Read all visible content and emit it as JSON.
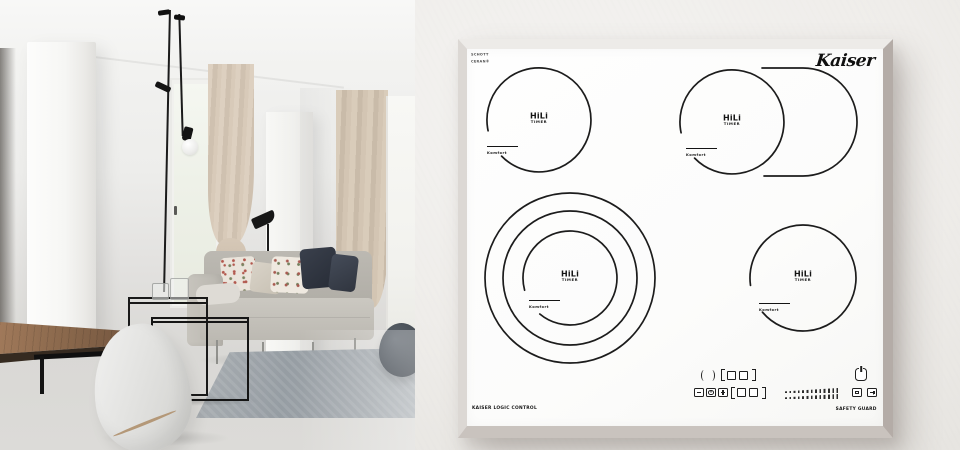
{
  "brand": "Kaiser",
  "glass_brand": {
    "line1": "SCHOTT",
    "line2": "CERAN®"
  },
  "hob": {
    "labels": {
      "logic_control": "KAISER LOGIC CONTROL",
      "safety_guard": "SAFETY GUARD"
    },
    "burner_labels": {
      "power_level": "HiLi",
      "timer": "TIMER",
      "comfort_zone": "Komfort"
    },
    "burners": [
      {
        "id": "rear-left",
        "cx": 72,
        "cy": 71,
        "rings": [
          {
            "r": 52,
            "gap": [
              136,
              168
            ]
          }
        ],
        "comfort": {
          "x": 20,
          "y": 89
        }
      },
      {
        "id": "rear-right",
        "cx": 265,
        "cy": 73,
        "rings": [
          {
            "r": 52,
            "gap": [
              136,
              168
            ]
          }
        ],
        "extension_path": "M 295 19 L 336 19 A 54 54 0 0 1 336 127 L 297 127",
        "comfort": {
          "x": 219,
          "y": 91
        }
      },
      {
        "id": "front-left",
        "cx": 103,
        "cy": 229,
        "rings": [
          {
            "r": 85
          },
          {
            "r": 67
          },
          {
            "r": 47,
            "gap": [
              130,
              165
            ]
          }
        ],
        "comfort": {
          "x": 62,
          "y": 243
        }
      },
      {
        "id": "front-right",
        "cx": 336,
        "cy": 229,
        "rings": [
          {
            "r": 53,
            "gap": [
              140,
              172
            ]
          }
        ],
        "comfort": {
          "x": 292,
          "y": 246
        }
      }
    ],
    "control_icons": [
      "residual-heat-brackets",
      "zone-select-squares",
      "timer-minus-key",
      "timer-clock-key",
      "timer-plus-key",
      "power-level-slider",
      "power-key",
      "stop-key",
      "lock-key"
    ]
  },
  "colors": {
    "backdrop": "#f0eeeb",
    "glass": "#fdfdfc",
    "frame_light": "#edebe8",
    "frame_shadow": "#b4aca7",
    "ink": "#1c1c1c"
  }
}
